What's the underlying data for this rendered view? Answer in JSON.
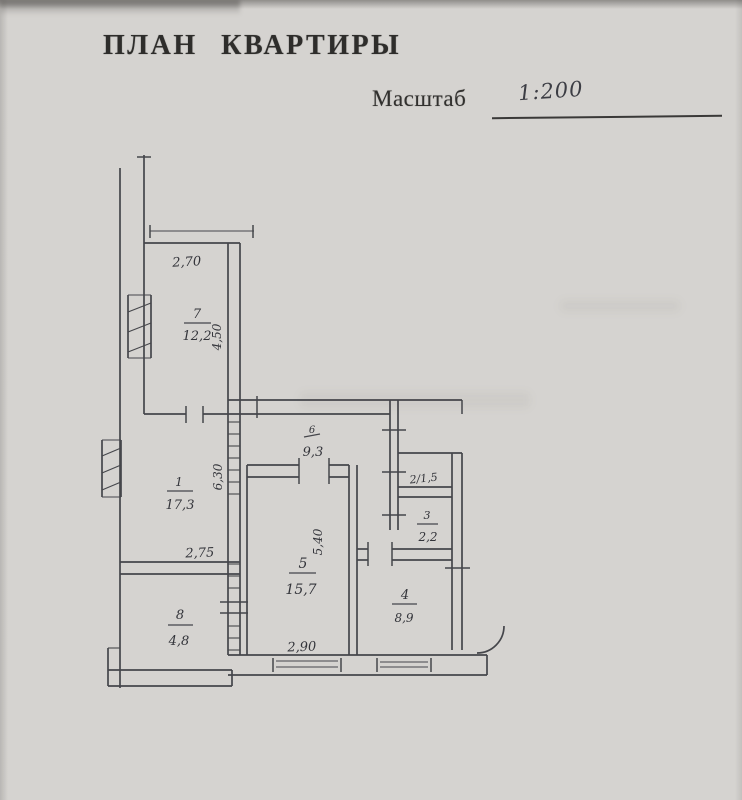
{
  "document": {
    "title": "ПЛАН КВАРТИРЫ",
    "scale_label": "Масштаб",
    "scale_value": "1:200"
  },
  "plan": {
    "rooms": {
      "r7": {
        "number": "7",
        "area": "12,2"
      },
      "r1": {
        "number": "1",
        "area": "17,3"
      },
      "r6": {
        "number": "6",
        "area": "9,3"
      },
      "r5": {
        "number": "5",
        "area": "15,7"
      },
      "r2": {
        "label": "2/1,5"
      },
      "r3": {
        "number": "3",
        "area": "2,2"
      },
      "r4": {
        "number": "4",
        "area": "8,9"
      },
      "r8": {
        "number": "8",
        "area": "4,8"
      }
    },
    "dimensions": {
      "room7_width": "2,70",
      "room7_depth": "4,50",
      "room1_width": "2,75",
      "room1_depth": "6,30",
      "room5_width": "2,90",
      "room5_depth": "5,40"
    }
  }
}
